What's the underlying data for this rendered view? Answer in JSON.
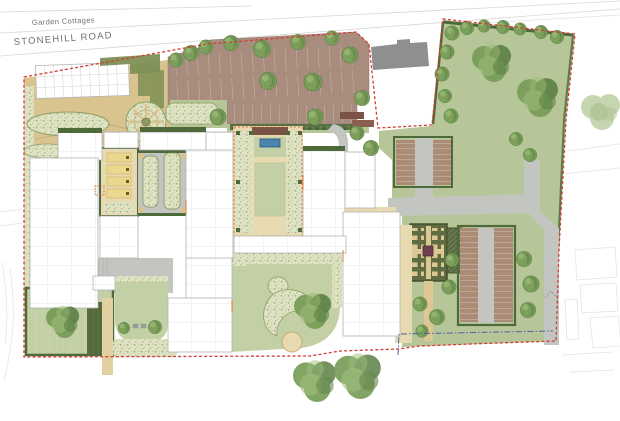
{
  "labels": {
    "garden_cottages": "Garden Cottages",
    "stonehill_road": "STONEHILL ROAD"
  },
  "palette": {
    "boundaryRed": "#d23c32",
    "blueLine": "#4b61a8",
    "lawn": "#b6c698",
    "lawnLight": "#c3cfa4",
    "hedge": "#4e6a3b",
    "hedgeLight": "#7d8f55",
    "tan": "#d9c38f",
    "tanLight": "#e7d9b0",
    "tanPale": "#efe5c8",
    "parking": "#a88d7e",
    "darkBrown": "#7a5246",
    "grey": "#c3c5c0",
    "greyDark": "#8d8f91",
    "allotment": "#a98b76",
    "gridGardenBg": "#5f6c41",
    "maroon": "#6d4150",
    "pool": "#4c84b0",
    "yellowBed": "#ead98c",
    "orangeAccent": "#e0763a",
    "buildingStroke": "#b3b3b3",
    "contextLine": "#d6d6d6",
    "textGrey": "#6f6f6f"
  }
}
